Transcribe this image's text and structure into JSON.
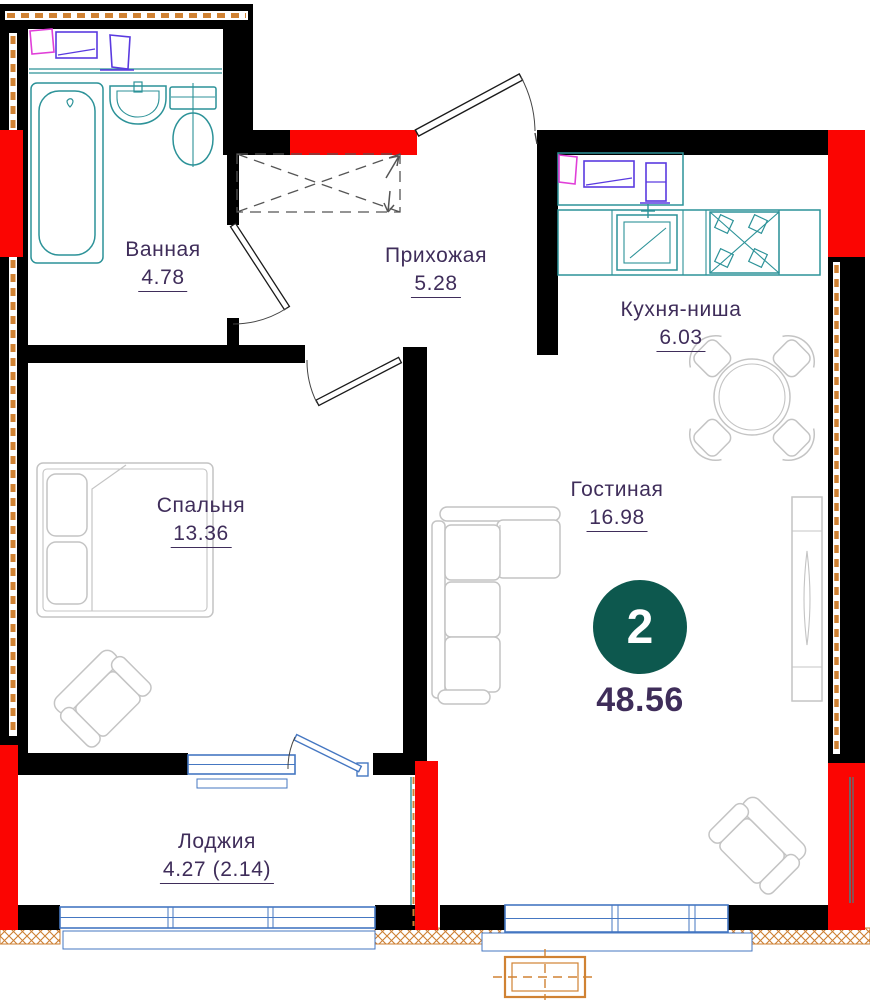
{
  "plan": {
    "type": "apartment-floor-plan",
    "badge": {
      "room_count": "2",
      "total_area": "48.56"
    },
    "rooms": [
      {
        "name": "Ванная",
        "area": "4.78"
      },
      {
        "name": "Прихожая",
        "area": "5.28"
      },
      {
        "name": "Кухня-ниша",
        "area": "6.03"
      },
      {
        "name": "Спальня",
        "area": "13.36"
      },
      {
        "name": "Гостиная",
        "area": "16.98"
      },
      {
        "name": "Лоджия",
        "area": "4.27 (2.14)"
      }
    ],
    "colors": {
      "walls": "#000000",
      "wall_accent_red": "#fb0502",
      "insulation_orange": "#cd7f32",
      "plumbing_teal": "#2c9298",
      "window_blue": "#4577c2",
      "furniture_gray": "#c4c4c4",
      "label_text": "#3f2d5a",
      "badge_fill": "#0d584e",
      "appliance_magenta": "#e03fd8",
      "appliance_violet": "#5a3ae0"
    }
  }
}
